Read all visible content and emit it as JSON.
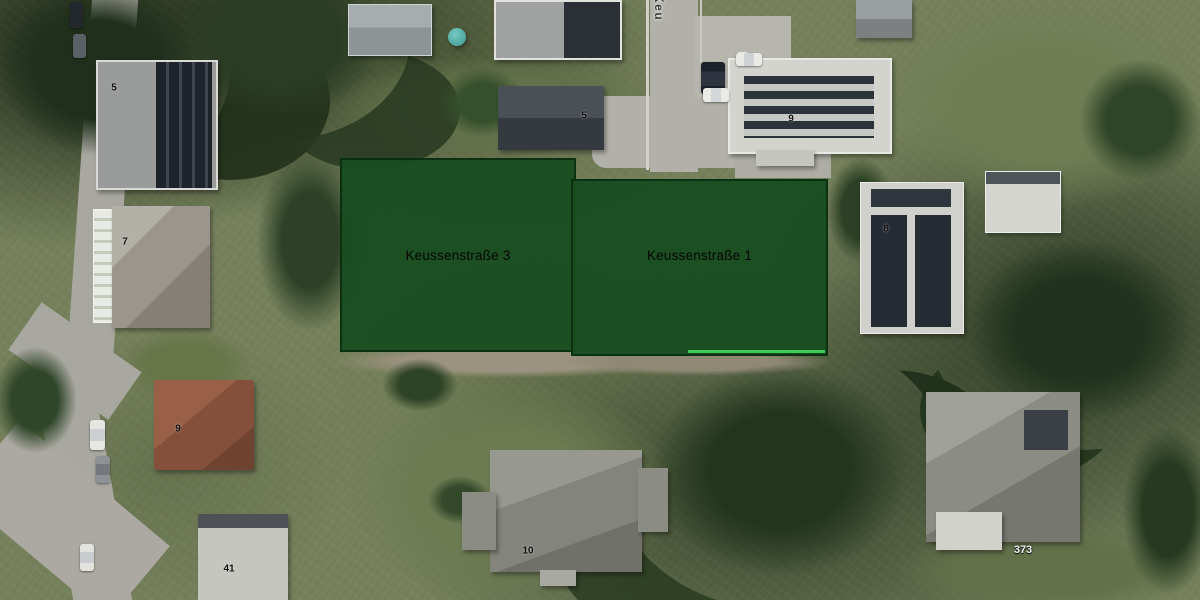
{
  "map": {
    "street_label": "Keu",
    "parcels": [
      {
        "label": "Keussenstraße 3"
      },
      {
        "label": "Keussenstraße 1"
      }
    ],
    "house_numbers": [
      "5",
      "7",
      "5",
      "9",
      "8",
      "9",
      "10",
      "41"
    ],
    "parcel_number": "373",
    "colors": {
      "parcel_fill": "#194d20",
      "parcel_border": "#072c0d",
      "parcel_boundary_highlight": "#3dcb55",
      "parcel_label_text": "#050505",
      "house_number_text": "#111111",
      "parcel_number_text": "#f0f0ee"
    }
  }
}
